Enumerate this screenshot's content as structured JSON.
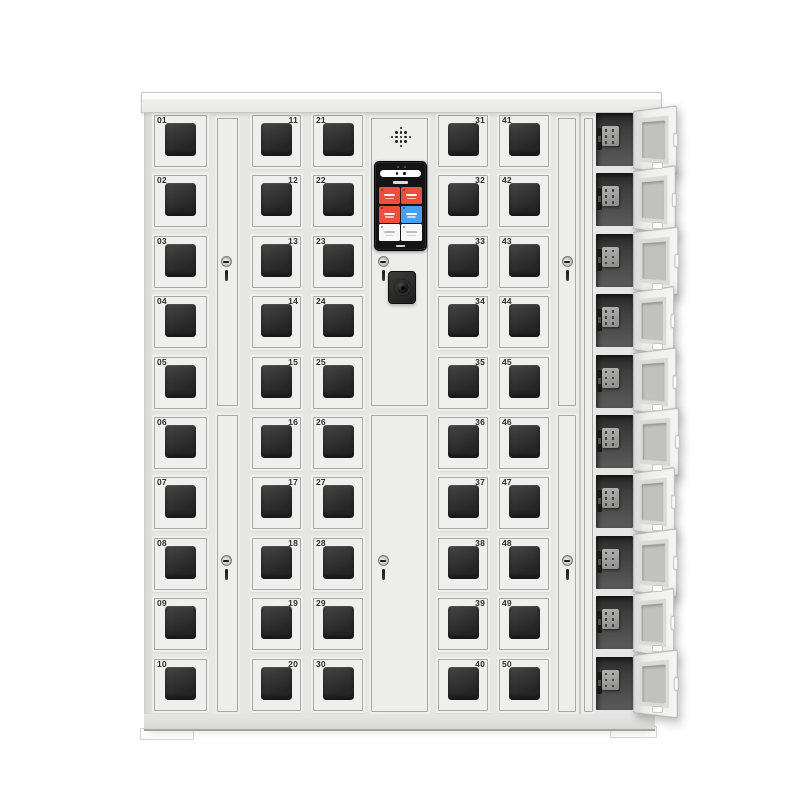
{
  "image_type": "product-photo",
  "subject": "smart electronic storage locker cabinet with 50 numbered windowed doors, central touchscreen console and a right-hand column of 10 open charging compartments",
  "cabinet": {
    "rows_per_column": 10,
    "door_columns": [
      {
        "numbers": [
          "01",
          "02",
          "03",
          "04",
          "05",
          "06",
          "07",
          "08",
          "09",
          "10"
        ],
        "number_position": "top-left"
      },
      {
        "numbers": [
          "11",
          "12",
          "13",
          "14",
          "15",
          "16",
          "17",
          "18",
          "19",
          "20"
        ],
        "number_position": "top-right"
      },
      {
        "numbers": [
          "21",
          "22",
          "23",
          "24",
          "25",
          "26",
          "27",
          "28",
          "29",
          "30"
        ],
        "number_position": "top-left"
      },
      {
        "numbers": [
          "31",
          "32",
          "33",
          "34",
          "35",
          "36",
          "37",
          "38",
          "39",
          "40"
        ],
        "number_position": "top-right"
      },
      {
        "numbers": [
          "41",
          "42",
          "43",
          "44",
          "45",
          "46",
          "47",
          "48",
          "49",
          "50"
        ],
        "number_position": "top-left"
      }
    ],
    "side_lock_panels": 2,
    "lock_keyholes": 6,
    "open_compartments": 10,
    "each_open_compartment_has": [
      "power-socket",
      "electronic-lock",
      "open-door"
    ]
  },
  "console": {
    "has_speaker_grille": true,
    "has_keyhole": true,
    "has_camera_module": true,
    "screen": {
      "tiles": [
        {
          "name": "screen-tile-1",
          "color": "#ee4f3c"
        },
        {
          "name": "screen-tile-2",
          "color": "#ee4f3c"
        },
        {
          "name": "screen-tile-3",
          "color": "#ee4f3c"
        },
        {
          "name": "screen-tile-4",
          "color": "#4aa0f0"
        },
        {
          "name": "screen-tile-5",
          "color": "#f7f7f7"
        },
        {
          "name": "screen-tile-6",
          "color": "#f7f7f7"
        }
      ]
    }
  },
  "colors": {
    "background": "#ffffff",
    "body": "#e6e6e4",
    "door": "#efefed",
    "door_outline": "#a8a8a6",
    "door_window": "#2d2d2d",
    "screen_bezel": "#141414",
    "accent_red": "#ee4f3c",
    "accent_blue": "#4aa0f0"
  }
}
